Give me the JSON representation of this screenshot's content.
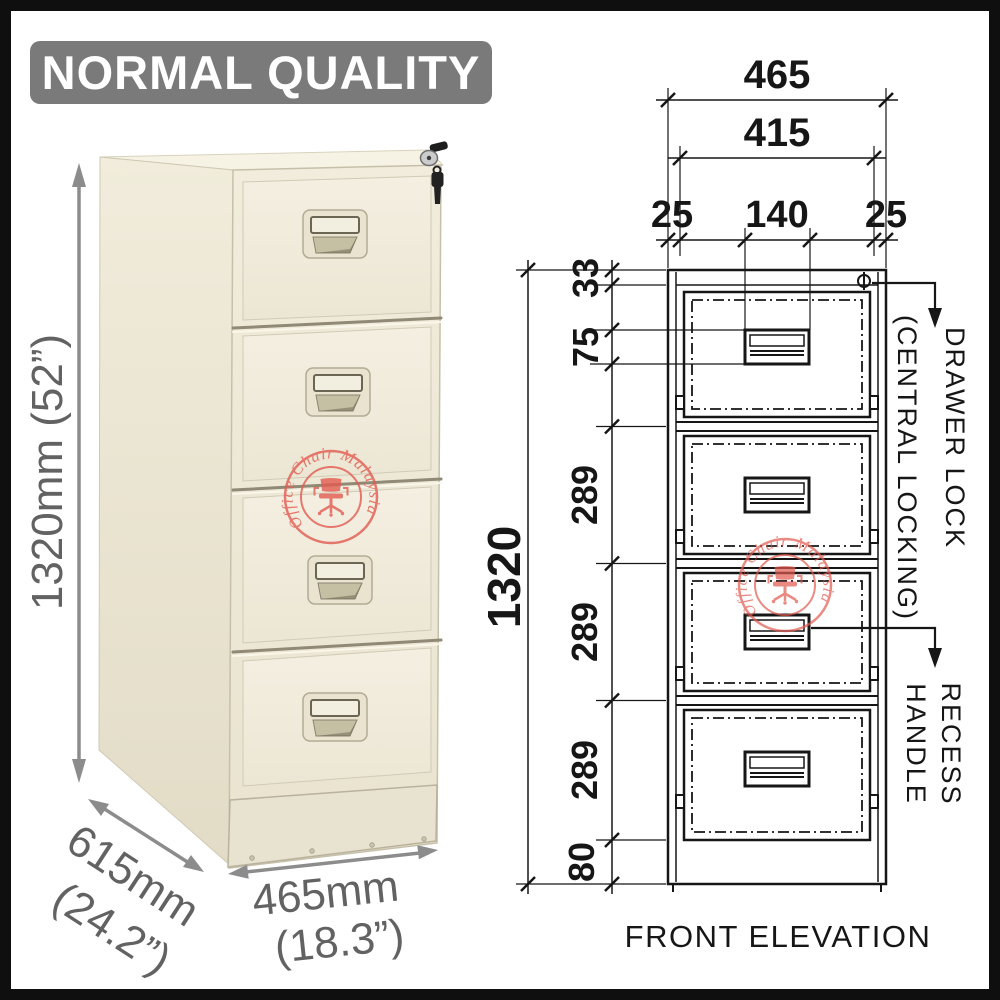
{
  "banner": {
    "label": "NORMAL QUALITY"
  },
  "watermark": {
    "text": "Office Chair Malaysia",
    "color": "#e25a50"
  },
  "photo": {
    "height_label": "1320mm (52”)",
    "depth_label_mm": "615mm",
    "depth_label_in": "(24.2”)",
    "width_label_mm": "465mm",
    "width_label_in": "(18.3”)"
  },
  "drawing": {
    "title": "FRONT ELEVATION",
    "dims": {
      "width_overall": "465",
      "width_inner": "415",
      "margin_left": "25",
      "handle_width": "140",
      "margin_right": "25",
      "height_overall": "1320",
      "top_rail": "33",
      "handle_height": "75",
      "pitches": [
        "289",
        "289",
        "289"
      ],
      "base_height": "80"
    },
    "callouts": {
      "lock_line1": "DRAWER LOCK",
      "lock_line2": "(CENTRAL LOCKING)",
      "recess_line1": "RECESS",
      "recess_line2": "HANDLE"
    }
  },
  "colors": {
    "frame_border": "#0f0f0f",
    "banner_bg": "#7a7a7a",
    "banner_text": "#ffffff",
    "cabinet_cream": "#f0ebd9",
    "drawing_line": "#161616",
    "dimension_gray": "#8c8c8c",
    "watermark_red": "#e25a50"
  }
}
